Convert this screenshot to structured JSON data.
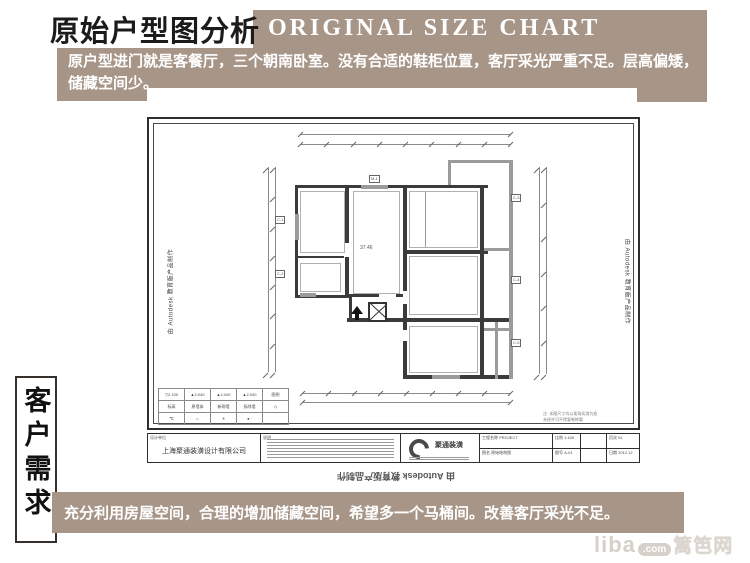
{
  "colors": {
    "tan": "#a79588",
    "ink": "#1b1b1b",
    "wall": "#3b3b3b",
    "gray_wall": "#9b9b9b"
  },
  "header": {
    "title_cn": "原始户型图分析",
    "title_en": "ORIGINAL SIZE CHART",
    "desc_line1": "原户型进门就是客餐厅，三个朝南卧室。没有合适的鞋柜位置，客厅采光严重不足。层高偏矮，",
    "desc_line2": "储藏空间少。"
  },
  "sidebar": {
    "vertical_label": "客户需求"
  },
  "footer": {
    "text": "充分利用房屋空间，合理的增加储藏空间，希望多一个马桶间。改善客厅采光不足。",
    "watermark_liba": "liba",
    "watermark_com": ".com",
    "watermark_cn": "篱笆网"
  },
  "sheet": {
    "watermark_left": "由 Autodesk 教育版产品制作",
    "watermark_right": "由 Autodesk 教育版产品制作",
    "watermark_bottom": "由 Autodesk 教育版产品制作",
    "area_label": "37.46",
    "notes_line1": "注: 本图尺寸均以现场实测为准",
    "notes_line2": "未经许可不得复制转载",
    "plan": {
      "walls": [
        [
          148,
          68,
          193,
          3,
          "w"
        ],
        [
          148,
          68,
          3,
          113,
          "w"
        ],
        [
          148,
          178,
          57,
          3,
          "w"
        ],
        [
          150,
          139,
          47,
          2,
          "w"
        ],
        [
          198,
          71,
          4,
          55,
          "w"
        ],
        [
          198,
          140,
          4,
          41,
          "w"
        ],
        [
          202,
          177,
          30,
          3,
          "w"
        ],
        [
          249,
          177,
          7,
          3,
          "w"
        ],
        [
          202,
          180,
          3,
          25,
          "w"
        ],
        [
          200,
          201,
          21,
          4,
          "w"
        ],
        [
          240,
          201,
          126,
          4,
          "w"
        ],
        [
          256,
          71,
          4,
          103,
          "w"
        ],
        [
          256,
          187,
          4,
          26,
          "w"
        ],
        [
          256,
          224,
          4,
          38,
          "w"
        ],
        [
          256,
          133,
          85,
          4,
          "w"
        ],
        [
          256,
          258,
          110,
          4,
          "w"
        ],
        [
          333,
          71,
          4,
          190,
          "w"
        ],
        [
          301,
          43,
          65,
          3,
          "g"
        ],
        [
          301,
          46,
          3,
          22,
          "g"
        ],
        [
          362,
          43,
          4,
          219,
          "g"
        ],
        [
          337,
          131,
          29,
          3,
          "g"
        ],
        [
          337,
          211,
          29,
          3,
          "g"
        ],
        [
          348,
          205,
          3,
          57,
          "g"
        ],
        [
          148,
          97,
          4,
          26,
          "g"
        ],
        [
          153,
          176,
          16,
          4,
          "g"
        ],
        [
          214,
          68,
          27,
          4,
          "g"
        ],
        [
          285,
          258,
          28,
          4,
          "g"
        ],
        [
          278,
          74,
          1,
          57,
          "t"
        ],
        [
          153,
          74,
          45,
          62,
          "tb"
        ],
        [
          153,
          146,
          41,
          29,
          "tb"
        ],
        [
          206,
          74,
          47,
          103,
          "tb"
        ],
        [
          262,
          74,
          69,
          57,
          "tb"
        ],
        [
          262,
          139,
          69,
          59,
          "tb"
        ],
        [
          262,
          209,
          69,
          47,
          "tb"
        ]
      ],
      "dims": [
        [
          153,
          17,
          "h",
          210,
          1
        ],
        [
          153,
          27,
          "h",
          210,
          8
        ],
        [
          121,
          50,
          "v",
          205,
          1
        ],
        [
          128,
          50,
          "v",
          205,
          7
        ],
        [
          392,
          50,
          "v",
          207,
          1
        ],
        [
          399,
          50,
          "v",
          207,
          6
        ],
        [
          155,
          276,
          "h",
          208,
          8
        ],
        [
          155,
          285,
          "h",
          208,
          1
        ]
      ],
      "tags": [
        [
          128,
          99,
          "C-1"
        ],
        [
          128,
          153,
          "C-2"
        ],
        [
          222,
          58,
          "M-1"
        ],
        [
          364,
          77,
          "C-3"
        ],
        [
          364,
          159,
          "C-4"
        ],
        [
          364,
          222,
          "C-5"
        ]
      ],
      "elevator": [
        221,
        185,
        19,
        20
      ],
      "entry_arrow": [
        204,
        189
      ]
    },
    "legend_rows": [
      [
        "▽2.100",
        "▲2.040",
        "▲2.040",
        "▲2.040",
        "图例"
      ],
      [
        "标高",
        "原墙体",
        "新砌墙",
        "拆除墙",
        "◇"
      ],
      [
        "℃",
        "☼",
        "✳",
        "● ·",
        ""
      ]
    ],
    "title_block": {
      "company_label": "设计单位",
      "company": "上海聚通装潢设计有限公司",
      "notes_label": "说明",
      "logo_text": "聚通装潢",
      "project_label": "工程名称",
      "project_value": "PROJECT",
      "drawing_label": "图名",
      "drawing_value": "原始结构图",
      "scale_label": "比例",
      "scale_value": "1:100",
      "no_label": "图号",
      "no_value": "A-01",
      "date_label": "日期",
      "date_value": "2012.12",
      "page_label": "页次",
      "page_value": "01"
    }
  }
}
